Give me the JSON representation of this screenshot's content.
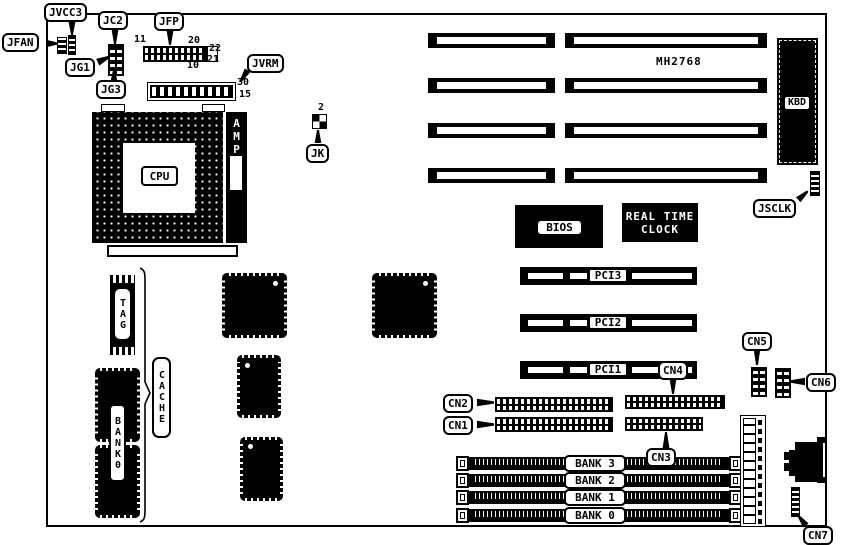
{
  "part_number": "MH2768",
  "labels": {
    "jfan": "JFAN",
    "jvcc3": "JVCC3",
    "jc2": "JC2",
    "jg1": "JG1",
    "jg3": "JG3",
    "jfp": "JFP",
    "jvrm": "JVRM",
    "jk": "JK",
    "jsclk": "JSCLK",
    "kbd": "KBD",
    "cn1": "CN1",
    "cn2": "CN2",
    "cn3": "CN3",
    "cn4": "CN4",
    "cn5": "CN5",
    "cn6": "CN6",
    "cn7": "CN7"
  },
  "chips": {
    "cpu": "CPU",
    "amp": "AMP",
    "bios": "BIOS",
    "rtc1": "REAL TIME",
    "rtc2": "CLOCK",
    "tag": "TAG",
    "cache": "CACHE",
    "bank0_chip": "BANK0"
  },
  "pins": {
    "jfp_11": "11",
    "jfp_20": "20",
    "jfp_22": "22",
    "jfp_21": "21",
    "jfp_10": "10",
    "jvrm_30": "30",
    "jvrm_15": "15",
    "jk_2": "2"
  },
  "slots": {
    "pci": [
      "PCI3",
      "PCI2",
      "PCI1"
    ],
    "banks": [
      "BANK 3",
      "BANK 2",
      "BANK 1",
      "BANK 0"
    ]
  },
  "colors": {
    "ink": "#000000",
    "paper": "#ffffff"
  }
}
